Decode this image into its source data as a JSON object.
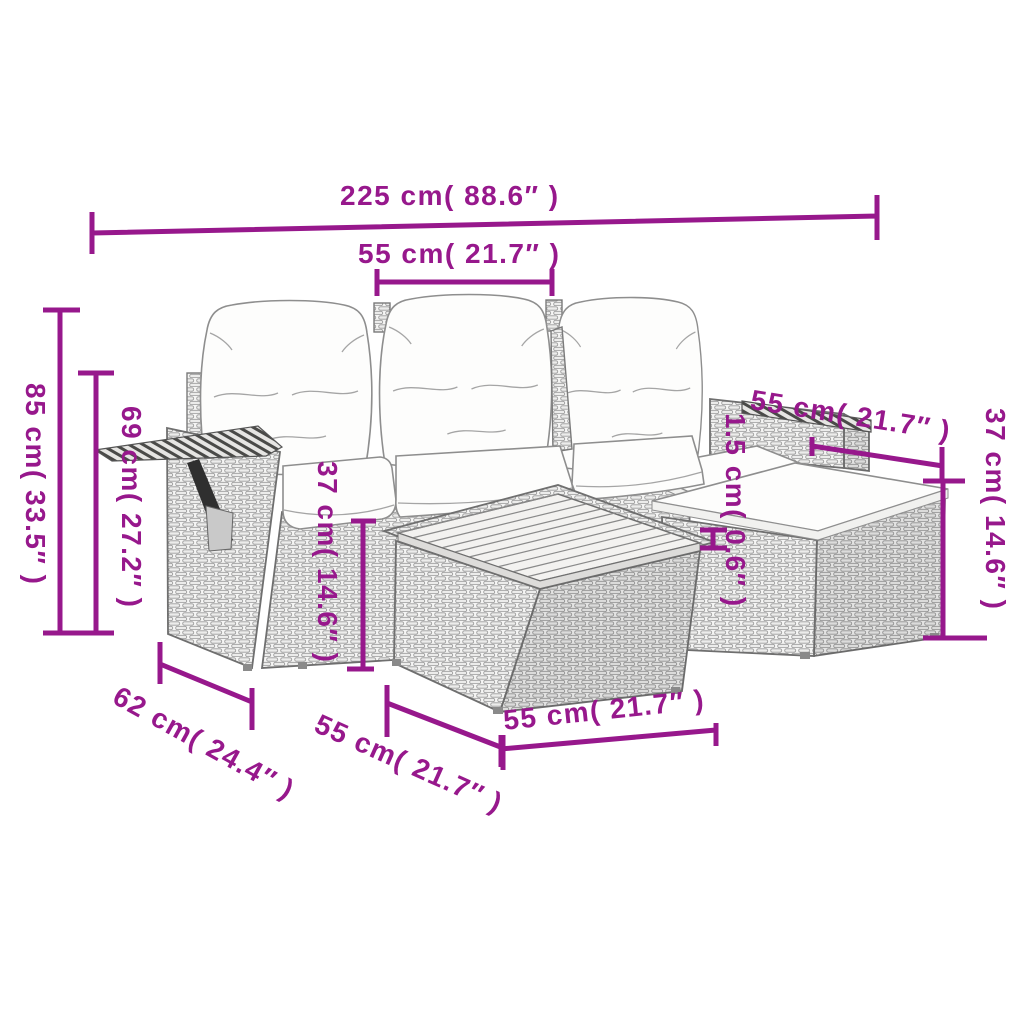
{
  "accent_color": "#97188C",
  "figure": {
    "description": "Garden lounge furniture set dimension diagram: three-seat poly rattan sofa with white cushions, wood side tray, corner backrest, footstool with cushion and square table with wood slat top",
    "dimensions": [
      {
        "id": "overall_width",
        "label": "225 cm( 88.6″ )"
      },
      {
        "id": "seat_width",
        "label": "55 cm( 21.7″ )"
      },
      {
        "id": "total_height",
        "label": "85 cm( 33.5″ )"
      },
      {
        "id": "armrest_height",
        "label": "69 cm( 27.2″ )"
      },
      {
        "id": "seat_height",
        "label": "37 cm( 14.6″ )"
      },
      {
        "id": "right_seat_width",
        "label": "55 cm( 21.7″ )"
      },
      {
        "id": "cushion_thickness",
        "label": "1.5 cm( 0.6″ )"
      },
      {
        "id": "footstool_height",
        "label": "37 cm( 14.6″ )"
      },
      {
        "id": "seat_depth",
        "label": "62 cm( 24.4″ )"
      },
      {
        "id": "table_depth",
        "label": "55 cm( 21.7″ )"
      },
      {
        "id": "table_width",
        "label": "55 cm( 21.7″ )"
      }
    ]
  }
}
